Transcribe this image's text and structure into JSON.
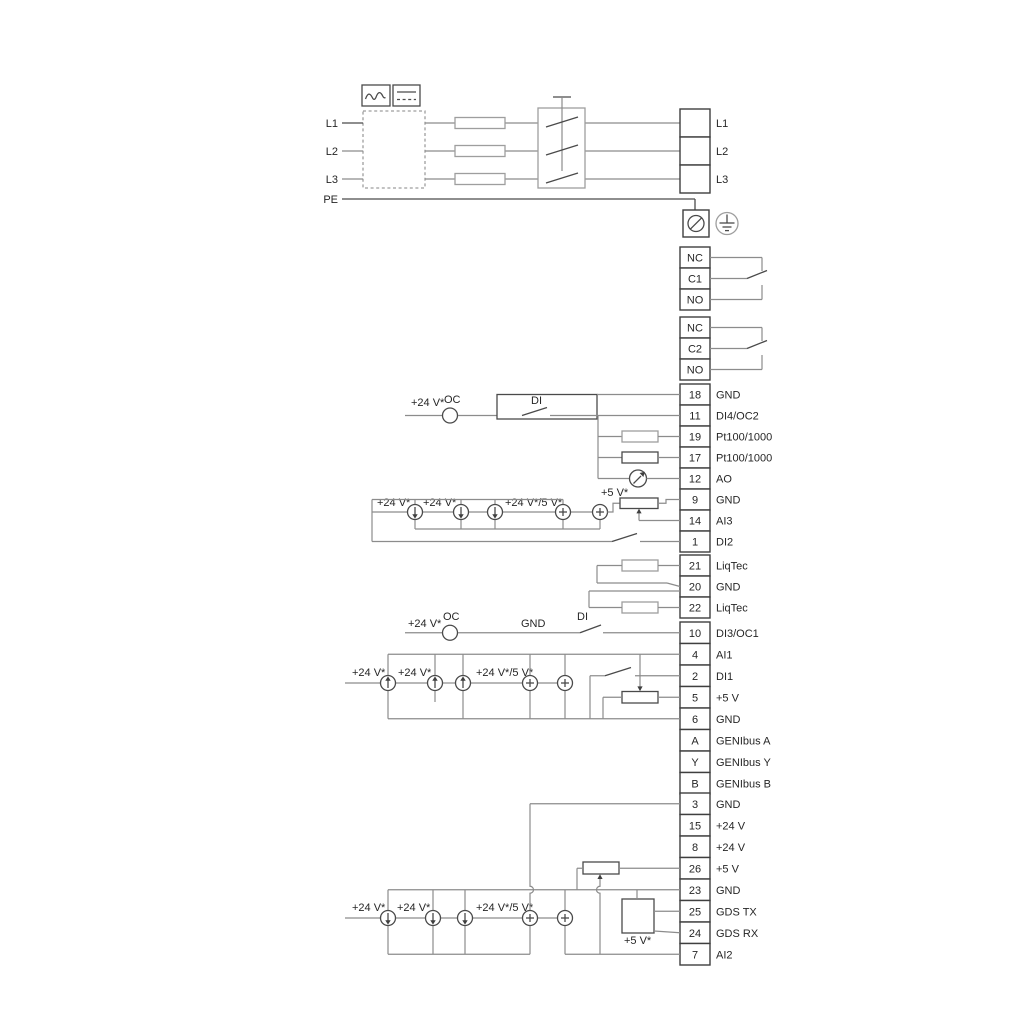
{
  "diagram_title": "Drive wiring diagram",
  "power": {
    "inputs": [
      "L1",
      "L2",
      "L3"
    ],
    "pe": "PE",
    "output": [
      "L1",
      "L2",
      "L3"
    ]
  },
  "relays": {
    "relay1": [
      "NC",
      "C1",
      "NO"
    ],
    "relay2": [
      "NC",
      "C2",
      "NO"
    ]
  },
  "strip_a": {
    "rows": [
      {
        "num": "18",
        "label": "GND"
      },
      {
        "num": "11",
        "label": "DI4/OC2"
      },
      {
        "num": "19",
        "label": "Pt100/1000"
      },
      {
        "num": "17",
        "label": "Pt100/1000"
      },
      {
        "num": "12",
        "label": "AO"
      },
      {
        "num": "9",
        "label": "GND"
      },
      {
        "num": "14",
        "label": "AI3"
      },
      {
        "num": "1",
        "label": "DI2"
      }
    ]
  },
  "strip_liqtec": {
    "rows": [
      {
        "num": "21",
        "label": "LiqTec"
      },
      {
        "num": "20",
        "label": "GND"
      },
      {
        "num": "22",
        "label": "LiqTec"
      }
    ]
  },
  "strip_b": {
    "rows": [
      {
        "num": "10",
        "label": "DI3/OC1"
      },
      {
        "num": "4",
        "label": "AI1"
      },
      {
        "num": "2",
        "label": "DI1"
      },
      {
        "num": "5",
        "label": "+5 V"
      },
      {
        "num": "6",
        "label": "GND"
      },
      {
        "num": "A",
        "label": "GENIbus A"
      },
      {
        "num": "Y",
        "label": "GENIbus Y"
      },
      {
        "num": "B",
        "label": "GENIbus B"
      }
    ]
  },
  "strip_c": {
    "rows": [
      {
        "num": "3",
        "label": "GND"
      },
      {
        "num": "15",
        "label": "+24 V"
      },
      {
        "num": "8",
        "label": "+24 V"
      },
      {
        "num": "26",
        "label": "+5 V"
      },
      {
        "num": "23",
        "label": "GND"
      },
      {
        "num": "25",
        "label": "GDS TX"
      },
      {
        "num": "24",
        "label": "GDS RX"
      },
      {
        "num": "7",
        "label": "AI2"
      }
    ]
  },
  "wire_labels": {
    "oc": "OC",
    "di": "DI",
    "gnd": "GND",
    "v24": "+24 V*",
    "v24v5": "+24 V*/5 V*",
    "v5": "+5 V*"
  },
  "colors": {
    "wire_gray": "#8c8c8c",
    "component_dark": "#4a4a4a",
    "light_gray": "#9e9e9e",
    "text": "#262626"
  },
  "icons": [
    "ac-waveform-icon",
    "dc-symbol-icon",
    "screw-terminal-icon",
    "earth-ground-icon",
    "meter-icon",
    "current-source-down-icon",
    "current-source-up-icon",
    "current-source-plus-icon"
  ]
}
